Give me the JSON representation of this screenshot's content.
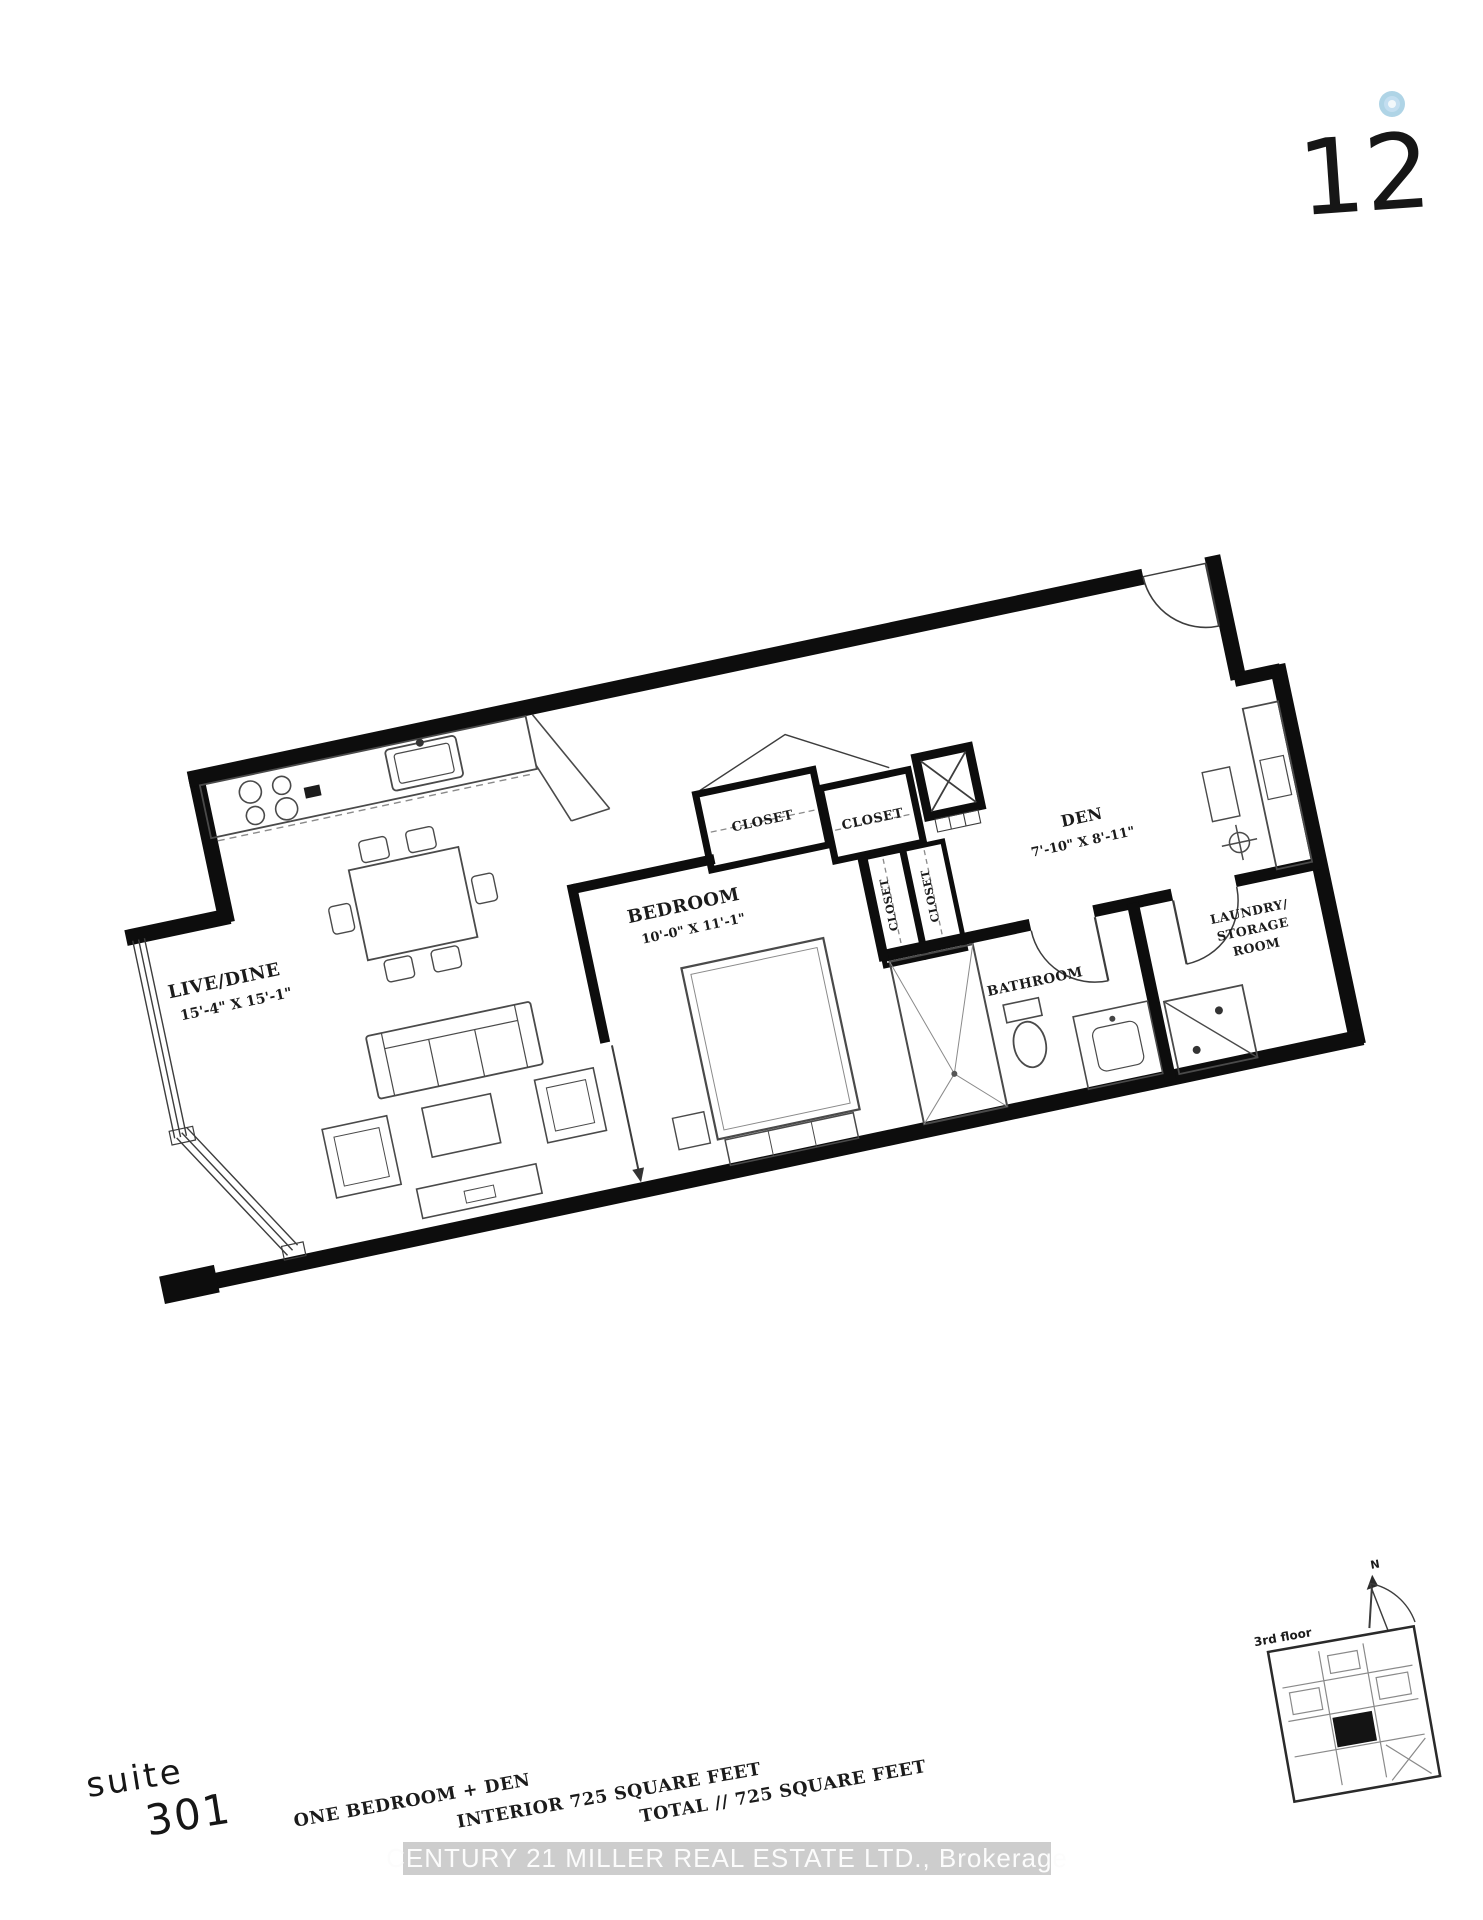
{
  "logo": {
    "number": "12",
    "degree_color": "#a6cfe3"
  },
  "plan": {
    "rooms": {
      "live_dine": {
        "name": "LIVE/DINE",
        "dims": "15'-4\" X 15'-1\""
      },
      "bedroom": {
        "name": "BEDROOM",
        "dims": "10'-0\" X 11'-1\""
      },
      "den": {
        "name": "DEN",
        "dims": "7'-10\" X 8'-11\""
      },
      "bathroom": {
        "name": "BATHROOM"
      },
      "laundry": {
        "line1": "LAUNDRY/",
        "line2": "STORAGE",
        "line3": "ROOM"
      },
      "closet_top_left": "CLOSET",
      "closet_top_right": "CLOSET",
      "closet_hall_left": "CLOSET",
      "closet_hall_right": "CLOSET"
    }
  },
  "suite": {
    "label": "suite",
    "number": "301"
  },
  "summary": {
    "type": "ONE BEDROOM + DEN",
    "interior": "INTERIOR 725 SQUARE FEET",
    "total": "TOTAL // 725 SQUARE FEET"
  },
  "watermark": "CENTURY 21 MILLER REAL ESTATE LTD., Brokerage",
  "keyplan": {
    "floor": "3rd floor",
    "north": "N"
  }
}
